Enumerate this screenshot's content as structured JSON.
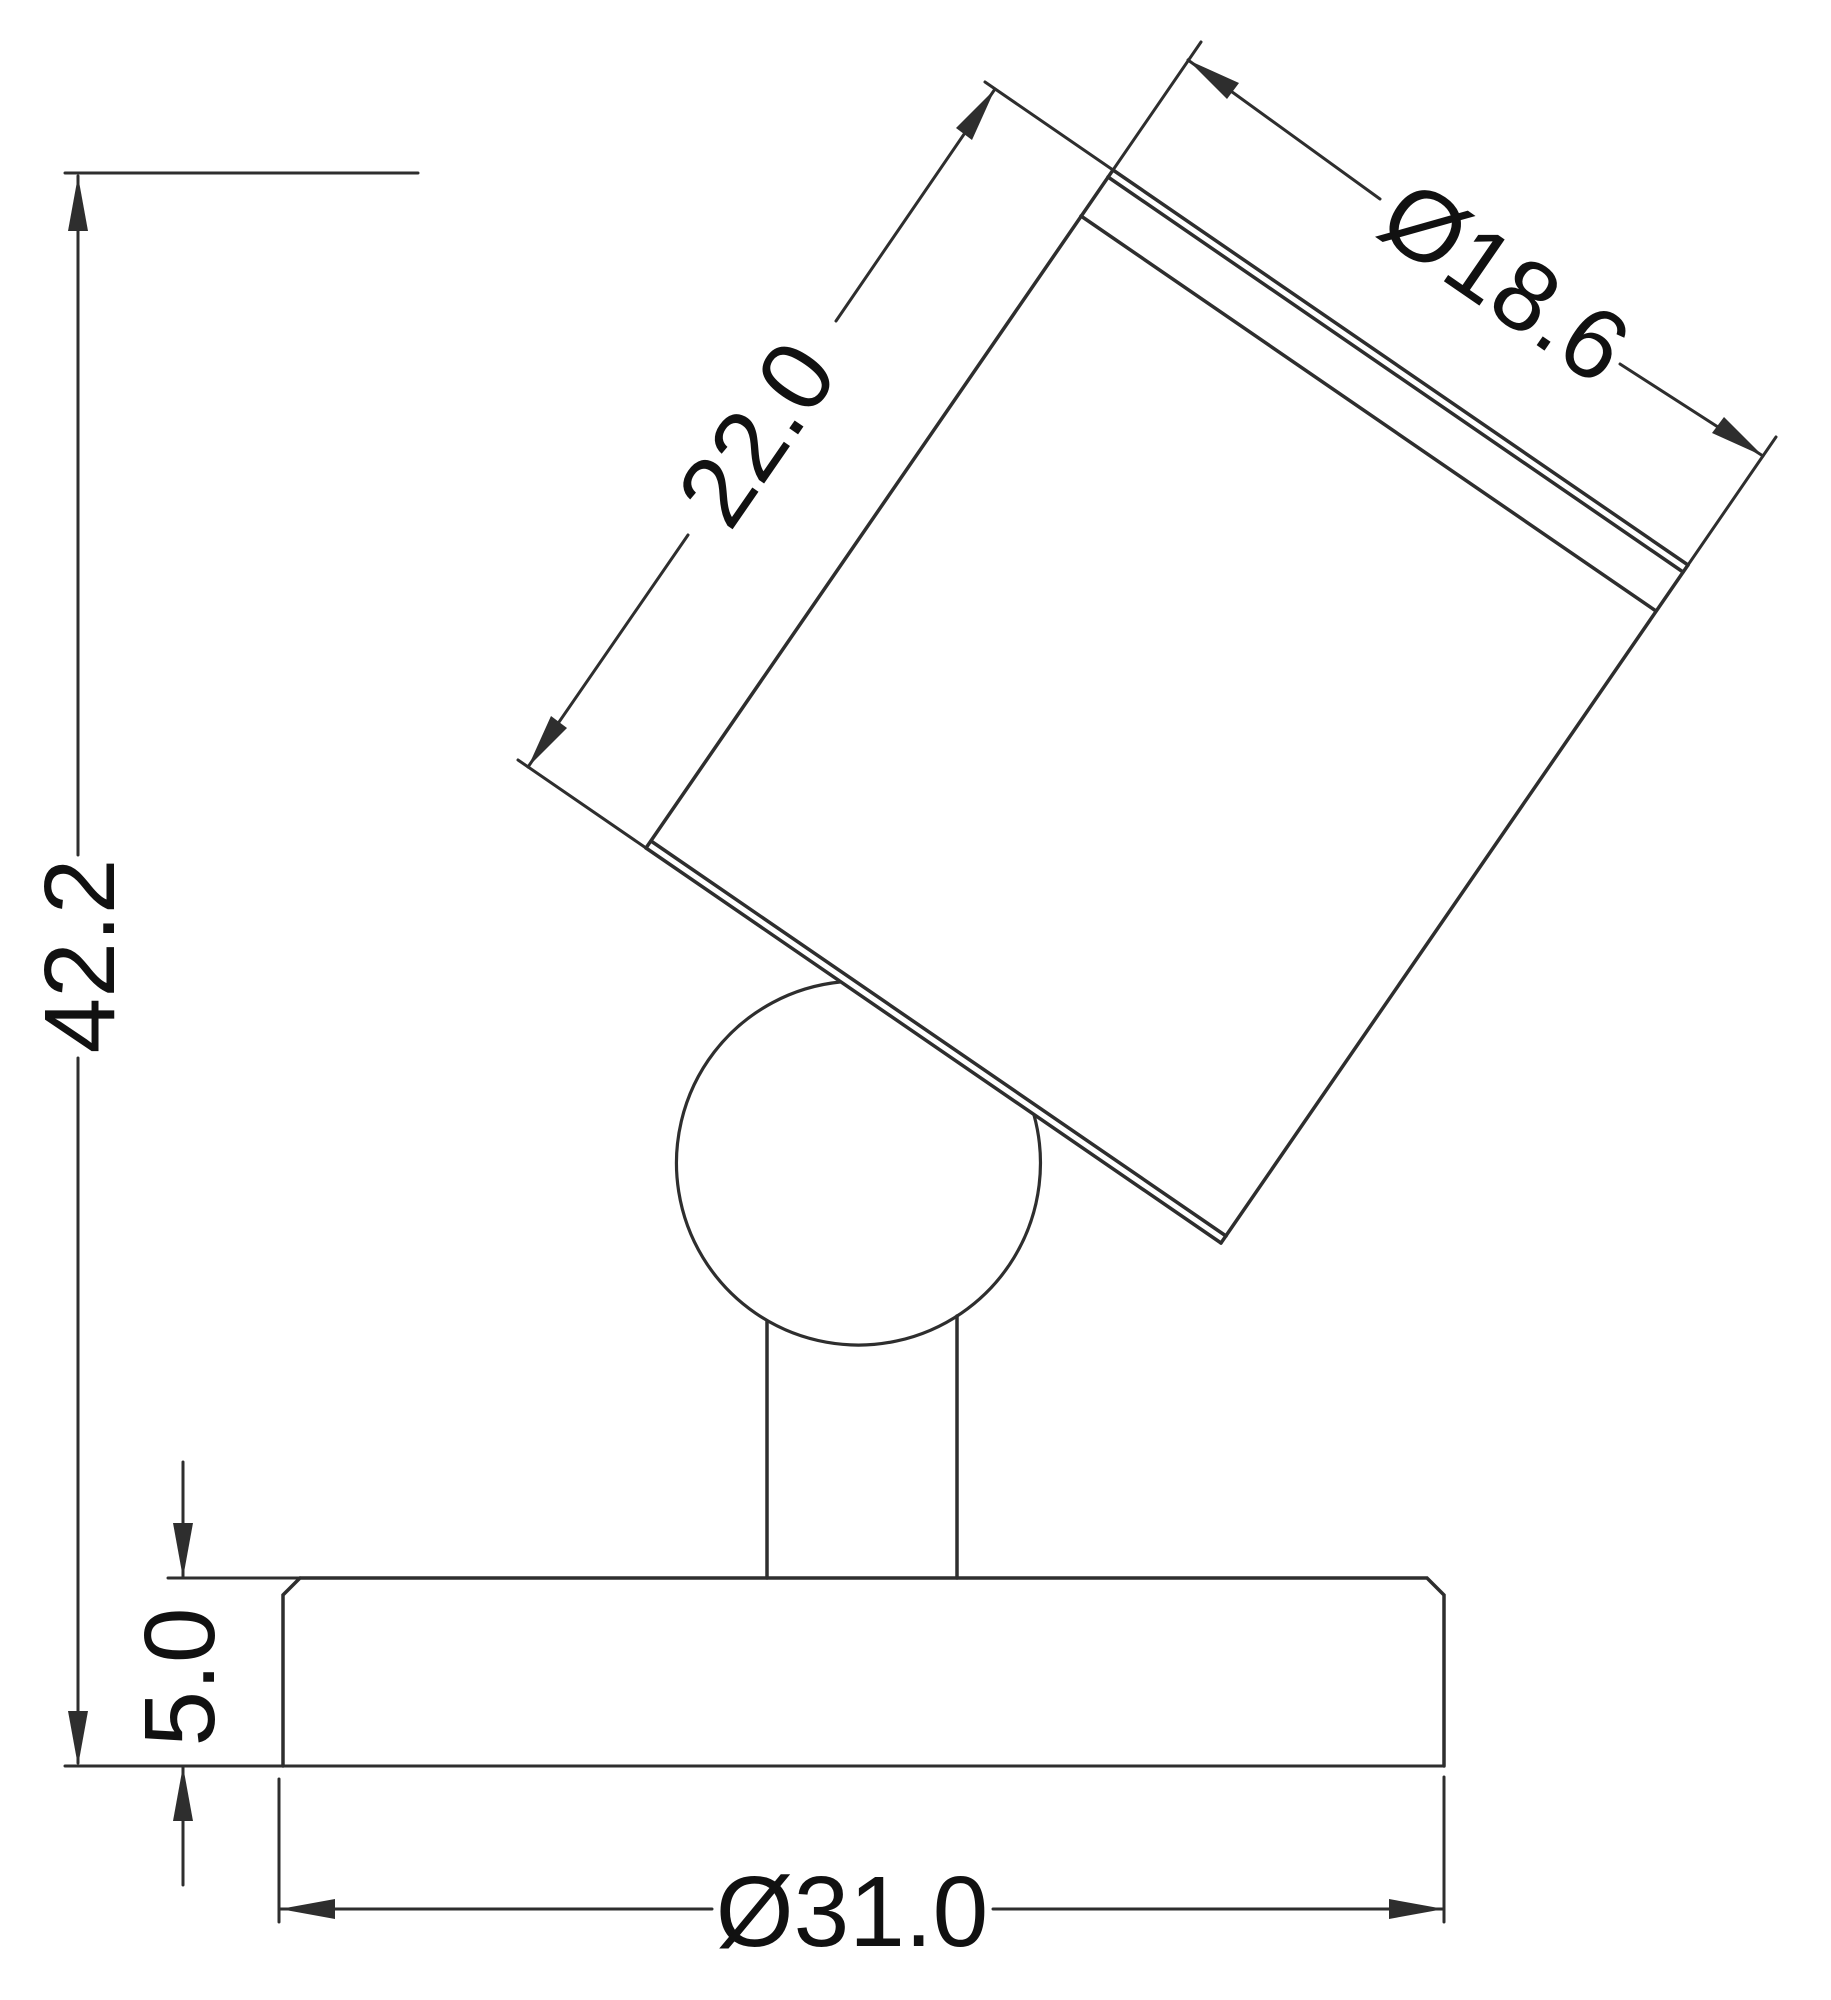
{
  "drawing": {
    "stroke_color": "#2e2e2e",
    "text_color": "#111111",
    "background": "#ffffff",
    "dimensions": {
      "overall_height": {
        "label": "42.2"
      },
      "head_length": {
        "label": "22.0"
      },
      "head_diameter": {
        "label": "Ø18.6"
      },
      "base_thickness": {
        "label": "5.0"
      },
      "base_diameter": {
        "label": "Ø31.0"
      }
    }
  }
}
